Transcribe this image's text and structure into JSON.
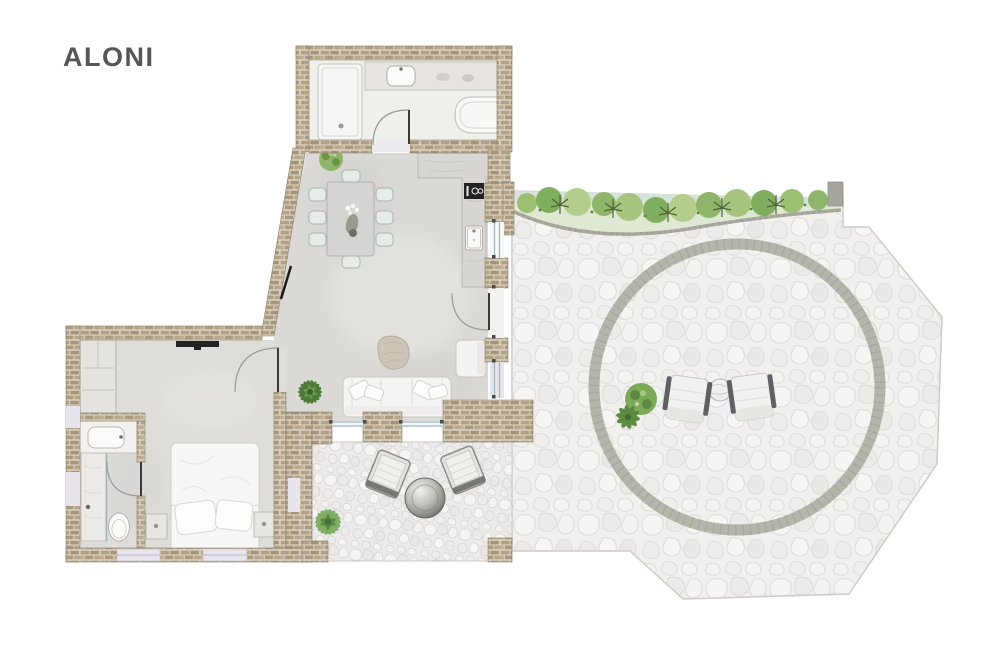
{
  "title": "ALONI",
  "colors": {
    "background": "#ffffff",
    "title_text": "#55565a",
    "wall_brick": "#b2a183",
    "wall_mortar": "#d9d0c0",
    "floor_concrete": "#dbdad7",
    "floor_bedroom": "#deddda",
    "floor_bath": "#efefec",
    "patio_stone": "#f1f0ee",
    "stone_outline": "#dcdbd7",
    "terrace_ring": "#b5b5ab",
    "glass": "#9fb6bd",
    "threshold": "#e8e5ed",
    "plant_green": "#7fae5e",
    "plant_dark": "#4e7a3a",
    "garden_tint": "#dfe8d2",
    "furniture_white": "#f4f4f2",
    "cooktop_black": "#222222"
  },
  "floorplan": {
    "name": "ALONI",
    "rooms": [
      "bathroom",
      "kitchen",
      "dining-area",
      "living-area",
      "bedroom",
      "ensuite-bathroom"
    ],
    "outdoor_elements": [
      "stone-patio",
      "circular-terrace",
      "garden-bed",
      "outdoor-lounge-chairs",
      "fire-bowl",
      "plants"
    ],
    "fixtures": [
      "shower",
      "vanity-sink",
      "bathtub",
      "cooktop",
      "kitchen-sink",
      "dining-table",
      "sofa",
      "coffee-table",
      "armchair",
      "wardrobe",
      "double-bed",
      "nightstands",
      "toilet",
      "tv"
    ]
  }
}
